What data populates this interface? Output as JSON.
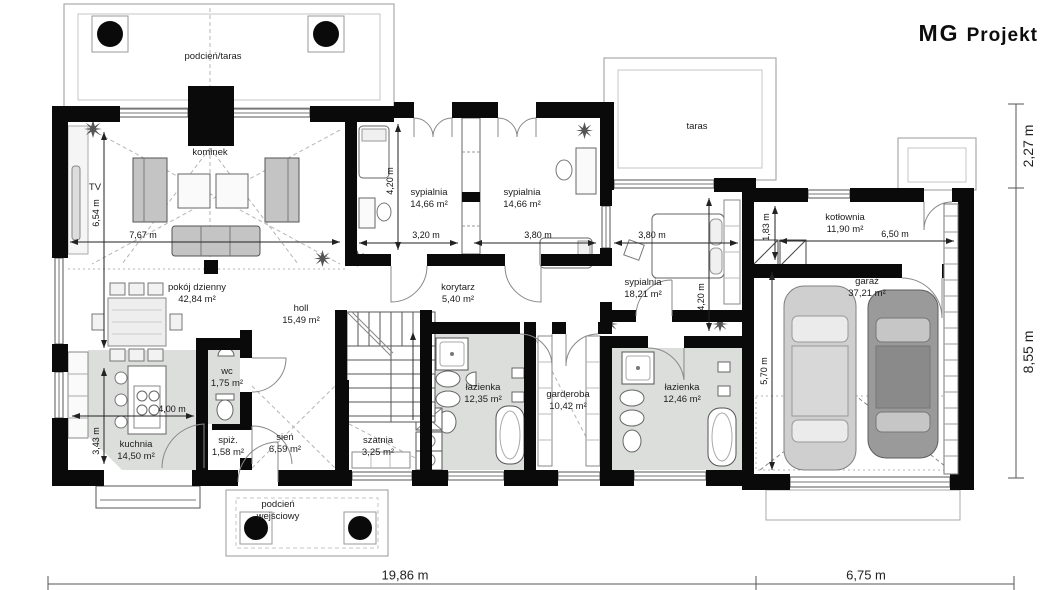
{
  "logo": {
    "brand_bold": "MG",
    "brand_rest": "Projekt"
  },
  "rooms": [
    {
      "name": "podcień/taras",
      "area": ""
    },
    {
      "name": "kominek",
      "area": ""
    },
    {
      "name": "TV",
      "area": ""
    },
    {
      "name": "pokój dzienny",
      "area": "42,84 m²"
    },
    {
      "name": "holl",
      "area": "15,49 m²"
    },
    {
      "name": "sypialnia",
      "area": "14,66 m²"
    },
    {
      "name": "sypialnia",
      "area": "14,66 m²"
    },
    {
      "name": "korytarz",
      "area": "5,40 m²"
    },
    {
      "name": "sypialnia",
      "area": "18,21 m²"
    },
    {
      "name": "taras",
      "area": ""
    },
    {
      "name": "kotłownia",
      "area": "11,90 m²"
    },
    {
      "name": "garaż",
      "area": "37,21 m²"
    },
    {
      "name": "łazienka",
      "area": "12,35 m²"
    },
    {
      "name": "garderoba",
      "area": "10,42 m²"
    },
    {
      "name": "łazienka",
      "area": "12,46 m²"
    },
    {
      "name": "kuchnia",
      "area": "14,50 m²"
    },
    {
      "name": "wc",
      "area": "1,75 m²"
    },
    {
      "name": "spiż.",
      "area": "1,58 m²"
    },
    {
      "name": "sień",
      "area": "6,59 m²"
    },
    {
      "name": "szatnia",
      "area": "3,25 m²"
    },
    {
      "name": "podcień",
      "area": "wejściowy"
    }
  ],
  "dims": [
    {
      "value": "6,54 m"
    },
    {
      "value": "7,67 m"
    },
    {
      "value": "3,43 m"
    },
    {
      "value": "4,00 m"
    },
    {
      "value": "4,20 m"
    },
    {
      "value": "3,20 m"
    },
    {
      "value": "3,80 m"
    },
    {
      "value": "3,80 m"
    },
    {
      "value": "4,20 m"
    },
    {
      "value": "1,83 m"
    },
    {
      "value": "6,50 m"
    },
    {
      "value": "5,70 m"
    },
    {
      "value": "2,27 m"
    },
    {
      "value": "8,55 m"
    },
    {
      "value": "19,86 m"
    },
    {
      "value": "6,75 m"
    }
  ],
  "colors": {
    "wall": "#0a0a0a",
    "wet_room_fill": "#dcdedc",
    "furniture_gray": "#c4c4c4"
  }
}
